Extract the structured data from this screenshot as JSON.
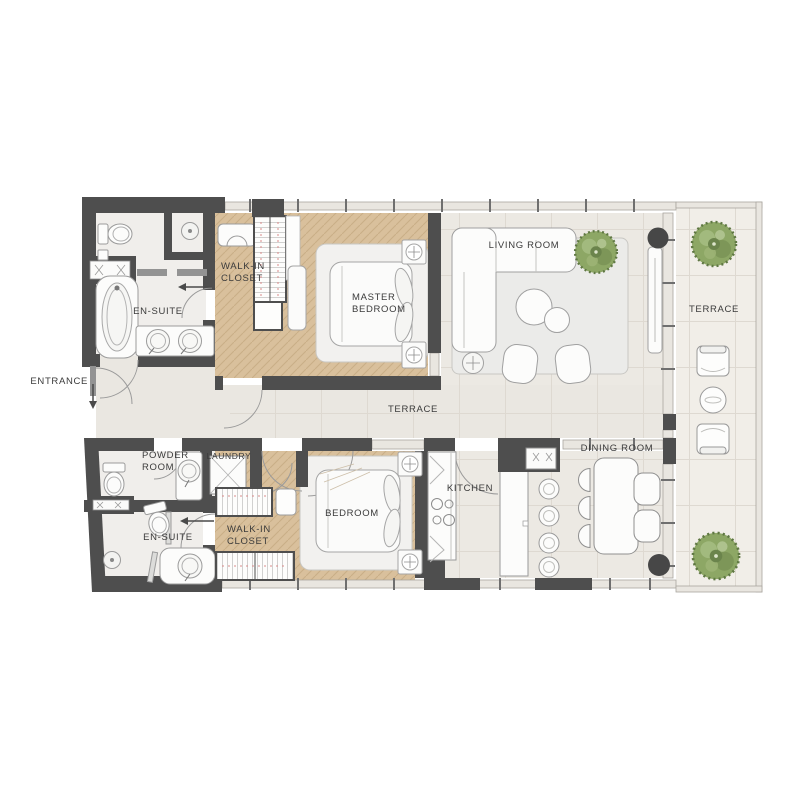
{
  "page": {
    "background": "#ffffff",
    "title": "Apartment Floor Plan"
  },
  "plan": {
    "labels": {
      "entrance": "ENTRANCE",
      "en_suite_upper": "EN-SUITE",
      "walk_in_closet_upper": "WALK-IN\nCLOSET",
      "master_bedroom": "MASTER\nBEDROOM",
      "living_room": "LIVING ROOM",
      "terrace_right": "TERRACE",
      "terrace_center": "TERRACE",
      "powder_room": "POWDER\nROOM",
      "laundry": "LAUNDRY",
      "en_suite_lower": "EN-SUITE",
      "walk_in_closet_lower": "WALK-IN\nCLOSET",
      "bedroom": "BEDROOM",
      "kitchen": "KITCHEN",
      "dining_room": "DINING ROOM"
    },
    "colors": {
      "wall": "#4e4e4e",
      "wood_floor": "#d9c09c",
      "interior_floor": "#eae7e1",
      "bath_floor": "#f0eeeb",
      "terrace_floor": "#f1eee8",
      "plant_green": "#8da765",
      "furniture_outline": "#9b9b9b",
      "label_text": "#3b3b3b",
      "closet_rail_accent": "#d98a8a"
    }
  }
}
